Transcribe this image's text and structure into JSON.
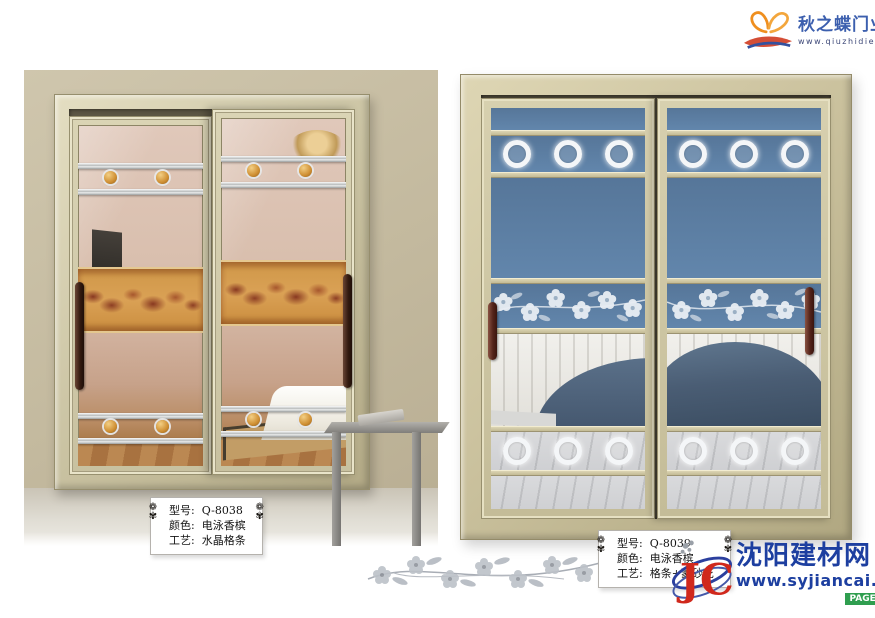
{
  "brand": {
    "name": "秋之蝶门业",
    "website": "www.qiuzhidie.com",
    "logo_icon": "butterfly-icon"
  },
  "products": [
    {
      "model_label": "型号:",
      "model_value": "Q-8038",
      "color_label": "颜色:",
      "color_value": "电泳香槟",
      "craft_label": "工艺:",
      "craft_value": "水晶格条"
    },
    {
      "model_label": "型号:",
      "model_value": "Q-8039",
      "color_label": "颜色:",
      "color_value": "电泳香槟",
      "craft_label": "工艺:",
      "craft_value": "格条+蒙砂花"
    }
  ],
  "watermark": {
    "site_name": "沈阳建材网",
    "site_url": "www.syjiancai.com",
    "page_label": "PAGE:",
    "page_number": "2 4",
    "logo_monogram": "JC",
    "logo_icon": "jc-monogram-icon"
  },
  "icons": {
    "label_ornament_glyph": "❁\n✾",
    "label_ornament": "floral-ornament-icon",
    "divider": "floral-branch-icon"
  },
  "colors": {
    "frame_champagne": "#cdc5a4",
    "wall_tan": "#c3b99e",
    "glass_blue": "#5d7fa5",
    "amber_band": "#d0964a",
    "sofa_navy": "#45586e",
    "handle_brown": "#53241a",
    "brand_blue": "#3c5fae",
    "watermark_blue": "#1d3fa0",
    "badge_green": "#2f9e4f",
    "badge_red": "#d0281c"
  }
}
